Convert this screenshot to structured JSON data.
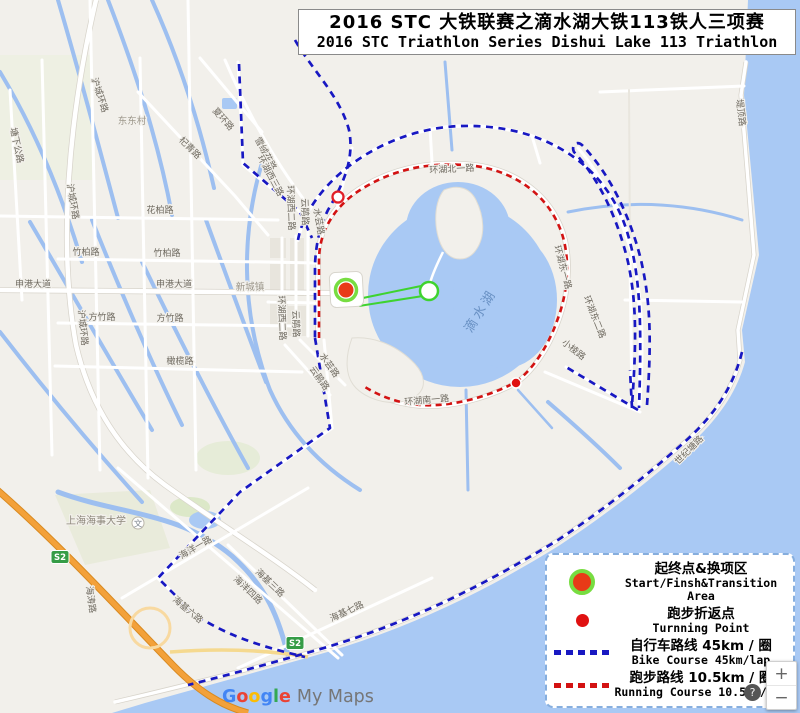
{
  "title": {
    "line1": "2016 STC 大铁联赛之滴水湖大铁113铁人三项赛",
    "line2": "2016 STC Triathlon Series  Dishui Lake 113 Triathlon"
  },
  "legend": {
    "items": [
      {
        "zh": "起终点&换项区",
        "en": "Start/Finsh&Transition Area"
      },
      {
        "zh": "跑步折返点",
        "en": "Turnning Point"
      },
      {
        "zh": "自行车路线 45km / 圈",
        "en": "Bike Course 45km/lap"
      },
      {
        "zh": "跑步路线 10.5km / 圈",
        "en": "Running Course 10.5km/lap"
      }
    ]
  },
  "watermark": {
    "letters": [
      "G",
      "o",
      "o",
      "g",
      "l",
      "e"
    ],
    "product": "My Maps"
  },
  "zoom_control": {
    "zoom_in": "+",
    "zoom_out": "−",
    "help": "?"
  },
  "map": {
    "shield": "S2",
    "school_icon": "文",
    "labels": [
      "东东村",
      "沪城环路",
      "沪城环路",
      "沪城环路",
      "塘下公路",
      "杞青路",
      "夏环路",
      "花柏路",
      "竹柏路",
      "竹柏路",
      "申港大道",
      "申港大道",
      "方竹路",
      "方竹路",
      "橄榄路",
      "雪绒花路",
      "环湖西三路",
      "环湖西二路",
      "云鹃路",
      "水芸路",
      "环湖西二路",
      "云鹃路",
      "水芸路",
      "云鹃路",
      "滴水湖",
      "环湖南一路",
      "环湖东一路",
      "环湖东二路",
      "小棱路",
      "上海海事大学",
      "海涛路",
      "海洋一路",
      "海洋四路",
      "海基三路",
      "海基七路",
      "海基六路",
      "世纪塘路",
      "堤顶路",
      "新城镇",
      "环湖北一路"
    ]
  },
  "colors": {
    "water": "#a9c9f4",
    "bike_course": "#1818c2",
    "run_course": "#d31212",
    "swim_course": "#3ed32f",
    "start_ring": "#77dd41",
    "start_dot": "#e83a17",
    "legend_border": "#86aede"
  }
}
